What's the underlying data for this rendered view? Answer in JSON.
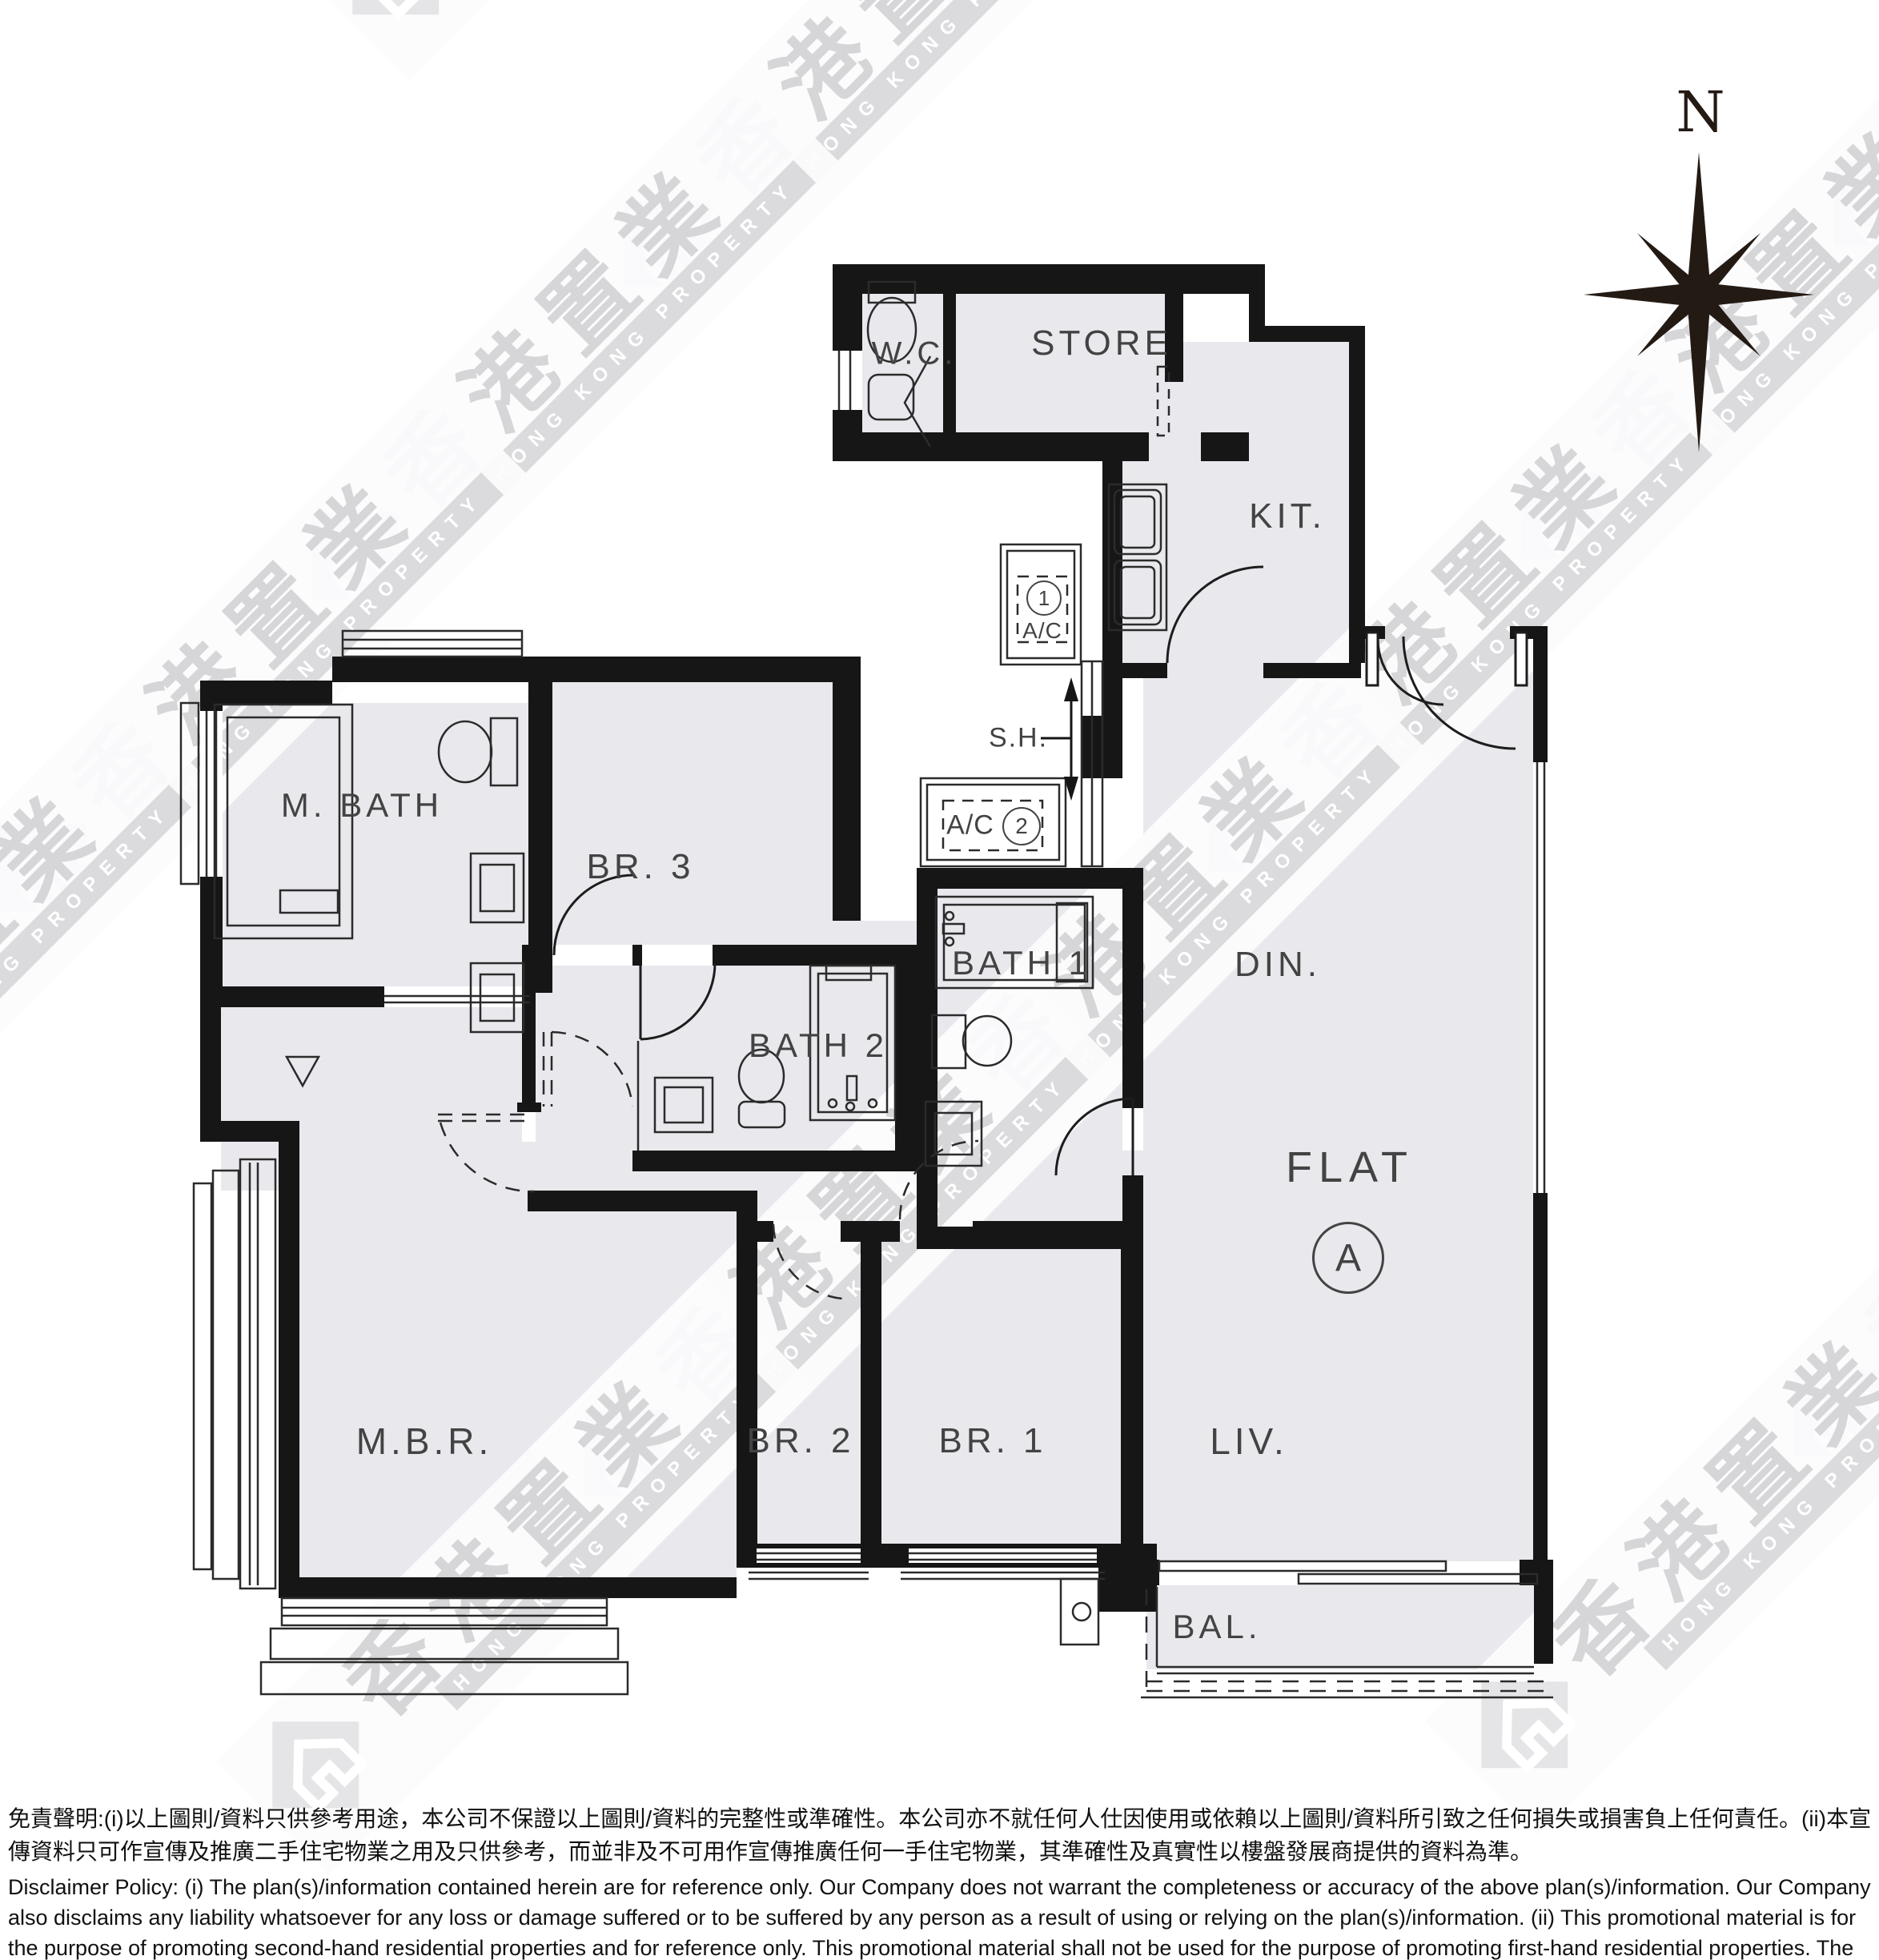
{
  "compass": {
    "north_label": "N"
  },
  "flat": {
    "label": "FLAT",
    "unit": "A"
  },
  "rooms": {
    "wc": "W.C.",
    "store": "STORE",
    "kit": "KIT.",
    "din": "DIN.",
    "bath1": "BATH 1",
    "bath2": "BATH 2",
    "mbath": "M. BATH",
    "br3": "BR. 3",
    "mbr": "M.B.R.",
    "br2": "BR. 2",
    "br1": "BR. 1",
    "liv": "LIV.",
    "bal": "BAL."
  },
  "annotations": {
    "sh": "S.H.",
    "ac": "A/C",
    "ac1_num": "1",
    "ac2_num": "2"
  },
  "watermark": {
    "brand_cn": "香港置業",
    "brand_en": "HONG KONG PROPERTY"
  },
  "disclaimer": {
    "zh": "免責聲明:(i)以上圖則/資料只供參考用途，本公司不保證以上圖則/資料的完整性或準確性。本公司亦不就任何人仕因使用或依賴以上圖則/資料所引致之任何損失或損害負上任何責任。(ii)本宣傳資料只可作宣傳及推廣二手住宅物業之用及只供參考，而並非及不可用作宣傳推廣任何一手住宅物業，其準確性及真實性以樓盤發展商提供的資料為準。",
    "en": "Disclaimer Policy: (i) The plan(s)/information contained herein are for reference only. Our Company does not warrant the completeness or accuracy of the above plan(s)/information. Our Company also disclaims any liability whatsoever for any loss or damage suffered or to be suffered by any person as a result of using or relying on the plan(s)/information. (ii) This promotional material is for the purpose of promoting second-hand residential properties and for reference only. This promotional material shall not be used for the purpose of promoting first-hand residential properties. The accuracy and truth of the information contained in this promotional material shall be subject to information provided by the developers."
  }
}
